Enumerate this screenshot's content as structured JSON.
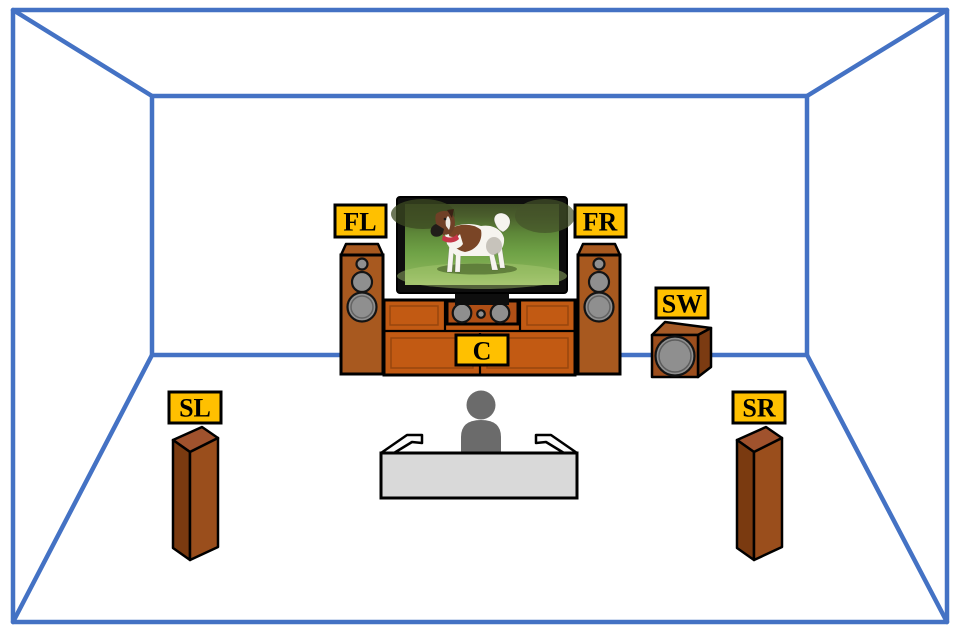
{
  "diagram": {
    "labels": {
      "front_left": "FL",
      "front_right": "FR",
      "center": "C",
      "subwoofer": "SW",
      "surround_left": "SL",
      "surround_right": "SR"
    },
    "colors": {
      "room_line": "#4472C4",
      "label_bg": "#FFC000",
      "label_border": "#000000",
      "label_text": "#000000",
      "cabinet_wood": "#C25A13",
      "center_speaker_wood": "#AF4F16",
      "tower_wood": "#A8591F",
      "tower_wood_dark": "#7A3A10",
      "tower_wood_side": "#9A4E1C",
      "tower_wood_top": "#A0522D",
      "sub_front": "#9C4E1D",
      "sub_top": "#A55A26",
      "sub_side": "#7B3B12",
      "driver_gray": "#8F8F8F",
      "tv_frame": "#0E0E0E",
      "grass_green": "#6FA246",
      "couch_fill": "#D9D9D9",
      "person_gray": "#6B6B6B",
      "background": "#FFFFFF"
    }
  }
}
